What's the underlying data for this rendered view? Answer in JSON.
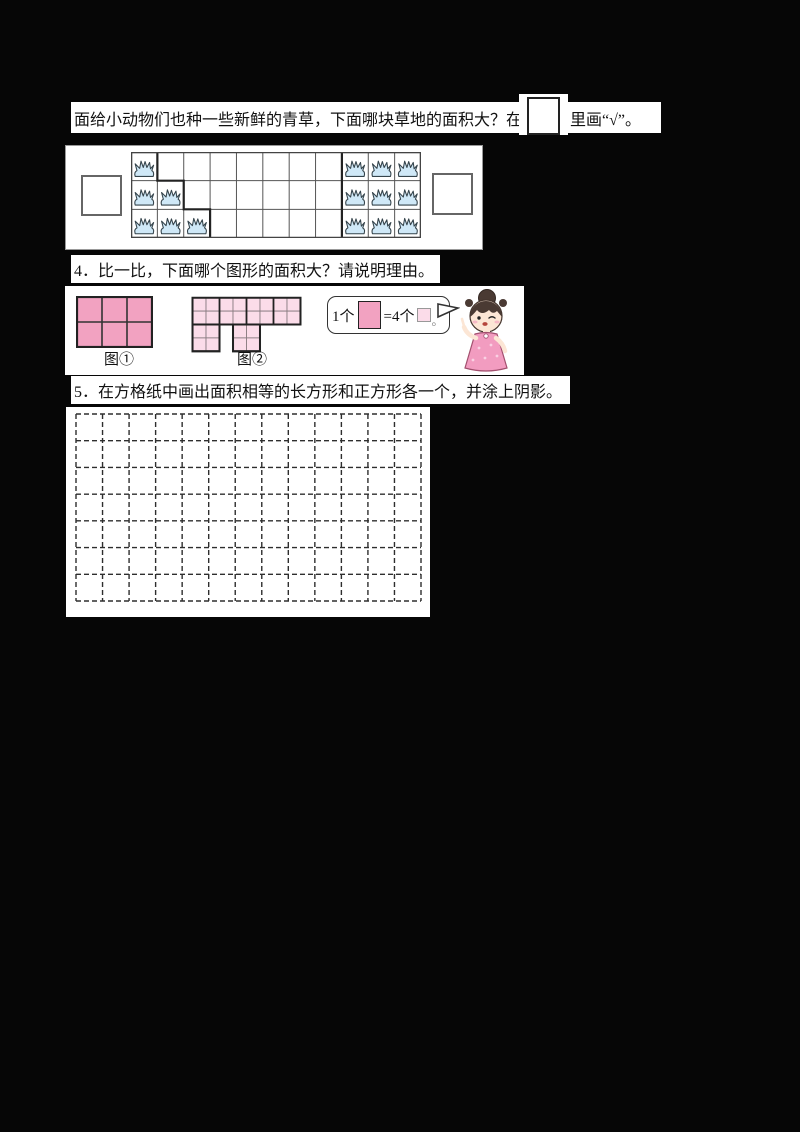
{
  "page": {
    "background": "#060606",
    "paper": "#ffffff"
  },
  "q3": {
    "prompt_before_box": "面给小动物们也种一些新鲜的青草，下面哪块草地的面积大？在",
    "prompt_after_box": "里画“√”。",
    "figure": {
      "grid": {
        "cols": 11,
        "rows": 3
      },
      "left_plot": {
        "shape": "staircase",
        "cells_per_row": [
          1,
          2,
          3
        ],
        "grass_count": 6
      },
      "right_plot": {
        "cols": 3,
        "rows": 3,
        "start_col": 8,
        "grass_count": 9
      },
      "grass_fill": "#cfe8f7",
      "grass_stroke": "#35444c",
      "line_color": "#555555",
      "bold_line_color": "#222222"
    }
  },
  "q4": {
    "number": "4．",
    "prompt": "比一比，下面哪个图形的面积大？请说明理由。",
    "figure1": {
      "label": "图①",
      "cols": 3,
      "rows": 2,
      "fill": "#f2a2c1",
      "unit": "large-square"
    },
    "figure2": {
      "label": "图②",
      "cols": 8,
      "rows": 4,
      "top_rows": 2,
      "leg_col_pairs": [
        [
          0,
          1
        ],
        [
          3,
          4
        ]
      ],
      "fill": "#fbdce9",
      "unit": "small-square",
      "small_square_count": 24
    },
    "bubble": {
      "text_before": "1个",
      "text_middle": "=4个",
      "text_end": "。",
      "big_square_fill": "#f2a2c1",
      "small_square_fill": "#fbdce9"
    }
  },
  "q5": {
    "number": "5．",
    "prompt": "在方格纸中画出面积相等的长方形和正方形各一个，并涂上阴影。",
    "grid": {
      "cols": 13,
      "rows": 7,
      "line_style": "dashed",
      "line_color": "#2e2e2e"
    }
  }
}
